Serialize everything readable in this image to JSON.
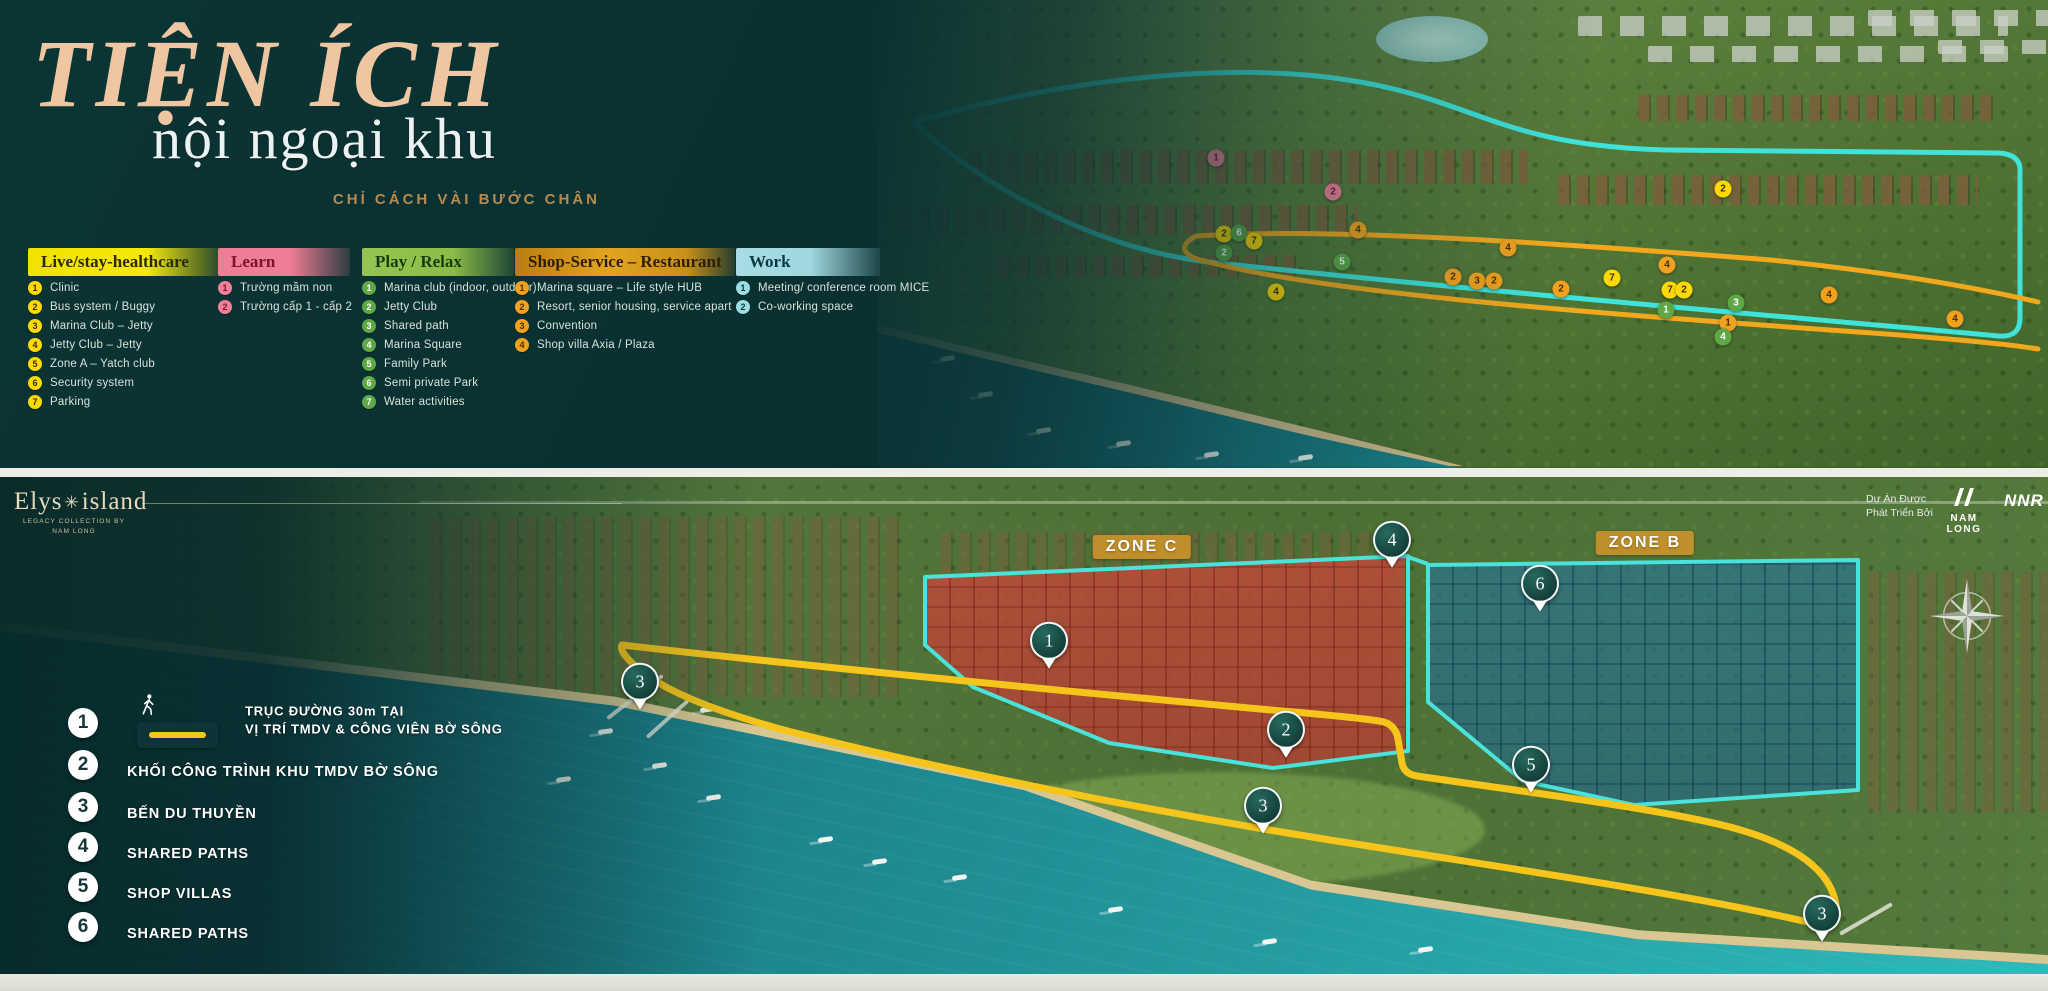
{
  "header": {
    "title": "TIỆN ÍCH",
    "subtitle": "nội ngoại khu",
    "tagline": "CHỈ CÁCH VÀI BƯỚC CHÂN"
  },
  "legend_categories": [
    {
      "label": "Live/stay-healthcare",
      "marker_color": "#ffd903",
      "marker_text_color": "#3a2f05",
      "items": [
        "Clinic",
        "Bus system / Buggy",
        "Marina Club – Jetty",
        "Jetty Club – Jetty",
        "Zone A – Yatch club",
        "Security system",
        "Parking"
      ]
    },
    {
      "label": "Learn",
      "marker_color": "#f07f97",
      "marker_text_color": "#7c1130",
      "items": [
        "Trường mầm non",
        "Trường cấp 1 - cấp 2"
      ]
    },
    {
      "label": "Play / Relax",
      "marker_color": "#5ea945",
      "marker_text_color": "#ffffff",
      "items": [
        "Marina club (indoor, outdoor)",
        "Jetty Club",
        "Shared path",
        "Marina Square",
        "Family Park",
        "Semi private Park",
        "Water activities"
      ]
    },
    {
      "label": "Shop-Service – Restaurant",
      "marker_color": "#f0a11f",
      "marker_text_color": "#4c2f05",
      "items": [
        "Marina square – Life style HUB",
        "Resort, senior housing, service apart",
        "Convention",
        "Shop villa Axia / Plaza"
      ]
    },
    {
      "label": "Work",
      "marker_color": "#9adde2",
      "marker_text_color": "#0c3a41",
      "items": [
        "Meeting/ conference room MICE",
        "Co-working space"
      ]
    }
  ],
  "top_map": {
    "route_colors": {
      "loop_outer": "#3fe3da",
      "loop_shore": "#f2a81d"
    },
    "markers": [
      {
        "cat": 1,
        "n": "1",
        "x": 338,
        "y": 158
      },
      {
        "cat": 1,
        "n": "2",
        "x": 455,
        "y": 192
      },
      {
        "cat": 0,
        "n": "2",
        "x": 346,
        "y": 234
      },
      {
        "cat": 2,
        "n": "6",
        "x": 361,
        "y": 233
      },
      {
        "cat": 0,
        "n": "7",
        "x": 376,
        "y": 241
      },
      {
        "cat": 2,
        "n": "2",
        "x": 346,
        "y": 253
      },
      {
        "cat": 3,
        "n": "4",
        "x": 480,
        "y": 230
      },
      {
        "cat": 2,
        "n": "5",
        "x": 464,
        "y": 262
      },
      {
        "cat": 0,
        "n": "4",
        "x": 398,
        "y": 292
      },
      {
        "cat": 3,
        "n": "2",
        "x": 575,
        "y": 277
      },
      {
        "cat": 3,
        "n": "3",
        "x": 599,
        "y": 281
      },
      {
        "cat": 3,
        "n": "2",
        "x": 616,
        "y": 281
      },
      {
        "cat": 3,
        "n": "4",
        "x": 630,
        "y": 248
      },
      {
        "cat": 3,
        "n": "2",
        "x": 683,
        "y": 289
      },
      {
        "cat": 0,
        "n": "7",
        "x": 734,
        "y": 278
      },
      {
        "cat": 0,
        "n": "2",
        "x": 845,
        "y": 189
      },
      {
        "cat": 3,
        "n": "4",
        "x": 789,
        "y": 265
      },
      {
        "cat": 0,
        "n": "7",
        "x": 792,
        "y": 290
      },
      {
        "cat": 0,
        "n": "2",
        "x": 806,
        "y": 290
      },
      {
        "cat": 2,
        "n": "1",
        "x": 788,
        "y": 310
      },
      {
        "cat": 2,
        "n": "3",
        "x": 858,
        "y": 303
      },
      {
        "cat": 3,
        "n": "1",
        "x": 850,
        "y": 323
      },
      {
        "cat": 2,
        "n": "4",
        "x": 845,
        "y": 337
      },
      {
        "cat": 3,
        "n": "4",
        "x": 951,
        "y": 295
      },
      {
        "cat": 3,
        "n": "4",
        "x": 1077,
        "y": 319
      }
    ]
  },
  "bottom_map": {
    "zones": [
      {
        "label": "ZONE C",
        "fill": "#bf4a3a",
        "badge_x": 1142,
        "badge_y": 70
      },
      {
        "label": "ZONE B",
        "fill": "#2a7694",
        "badge_x": 1645,
        "badge_y": 66
      }
    ],
    "outline_color": "#4ae2da",
    "route_color": "#f6c51b",
    "pins": [
      {
        "n": "4",
        "x": 1392,
        "y": 548
      },
      {
        "n": "6",
        "x": 1540,
        "y": 592
      },
      {
        "n": "1",
        "x": 1049,
        "y": 649
      },
      {
        "n": "3",
        "x": 640,
        "y": 690
      },
      {
        "n": "2",
        "x": 1286,
        "y": 738
      },
      {
        "n": "3",
        "x": 1263,
        "y": 814
      },
      {
        "n": "5",
        "x": 1531,
        "y": 773
      },
      {
        "n": "3",
        "x": 1822,
        "y": 922
      }
    ],
    "brand": {
      "name_prefix": "Elys",
      "name_suffix": "island",
      "collection_line1": "LEGACY COLLECTION BY",
      "collection_line2": "NAM LONG"
    },
    "credits": {
      "line1": "Dự Án Được",
      "line2": "Phát Triển Bởi",
      "developer": "NAM LONG",
      "partner": "NNR"
    }
  },
  "bottom_legend": [
    {
      "num": "1",
      "line1": "TRỤC ĐƯỜNG 30m TẠI",
      "line2": "VỊ TRÍ TMDV & CÔNG VIÊN BỜ SÔNG",
      "has_swatch": true
    },
    {
      "num": "2",
      "line1": "KHỐI CÔNG TRÌNH KHU TMDV BỜ SÔNG"
    },
    {
      "num": "3",
      "line1": "BẾN DU THUYỀN"
    },
    {
      "num": "4",
      "line1": "SHARED PATHS"
    },
    {
      "num": "5",
      "line1": "SHOP VILLAS"
    },
    {
      "num": "6",
      "line1": "SHARED PATHS"
    }
  ]
}
